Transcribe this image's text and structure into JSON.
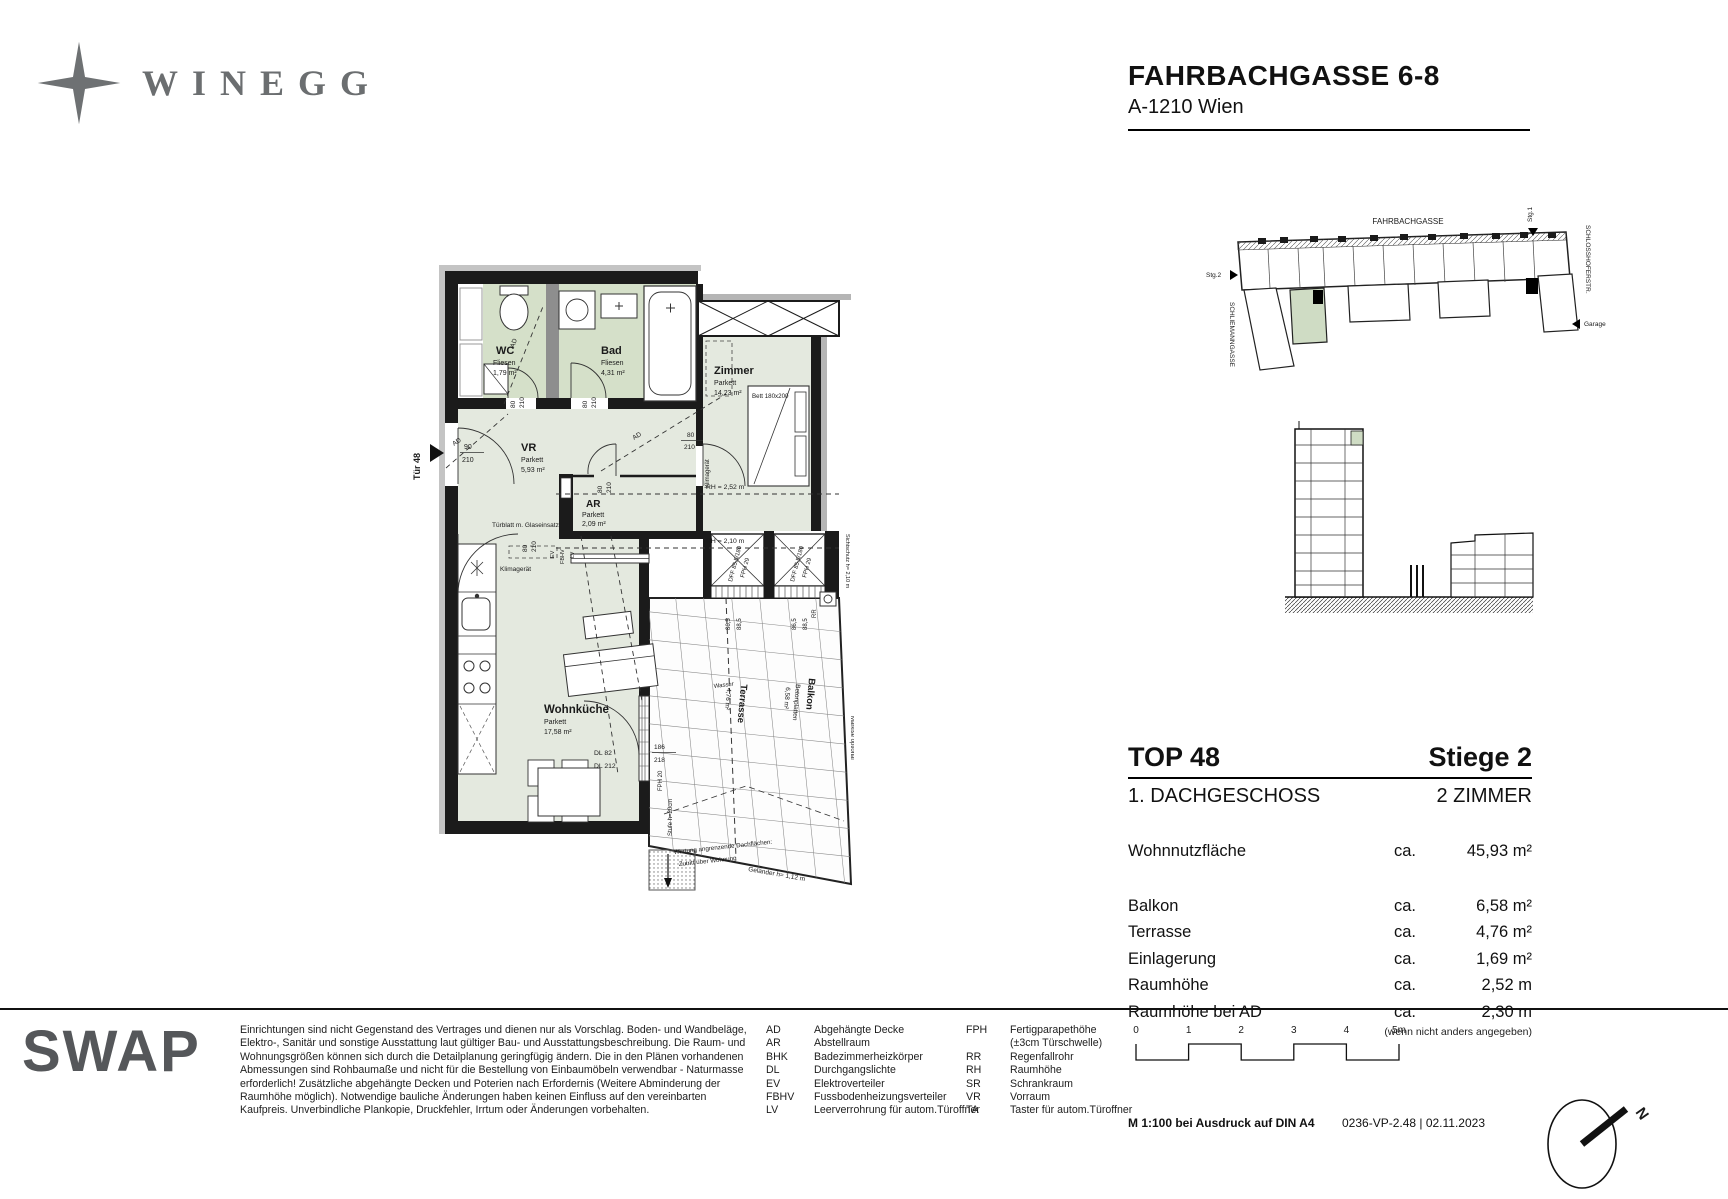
{
  "header": {
    "logo": "WINEGG",
    "title": "FAHRBACHGASSE 6-8",
    "subtitle": "A-1210 Wien"
  },
  "site_plan": {
    "street_top": "FAHRBACHGASSE",
    "street_right": "SCHLOSSHOFERSTR.",
    "street_left": "SCHLIEMANNGASSE",
    "stg1": "Stg.1",
    "stg2": "Stg.2",
    "garage": "Garage"
  },
  "floor_plan": {
    "door_label": "Tür 48",
    "entry_dim": {
      "w": "90",
      "h": "210"
    },
    "door_dim": {
      "w": "80",
      "h": "210"
    },
    "rooms": {
      "wc": {
        "name": "WC",
        "floor": "Fliesen",
        "area": "1,79 m²"
      },
      "bad": {
        "name": "Bad",
        "floor": "Fliesen",
        "area": "4,31 m²"
      },
      "zimmer": {
        "name": "Zimmer",
        "floor": "Parkett",
        "area": "14,23 m²"
      },
      "vr": {
        "name": "VR",
        "floor": "Parkett",
        "area": "5,93 m²"
      },
      "ar": {
        "name": "AR",
        "floor": "Parkett",
        "area": "2,09 m²"
      },
      "wohnkueche": {
        "name": "Wohnküche",
        "floor": "Parkett",
        "area": "17,58 m²"
      },
      "terrasse": {
        "name": "Terrasse",
        "area": "4,76 m²"
      },
      "balkon": {
        "name": "Balkon",
        "floor": "Betonplatten",
        "area": "6,58 m²"
      }
    },
    "annotations": {
      "ad": "AD",
      "bett": "Bett 180x200",
      "rh_high": "RH = 2,52 m",
      "rh_low": "RH = 2,10 m",
      "klimageraet": "Klimagerät",
      "tuerblatt": "Türblatt m. Glaseinsatz",
      "ev": "EV",
      "fbhv": "FBHV",
      "lv": "LV",
      "dff": "DFF 85,5/180",
      "fph29": "FPH 29",
      "dim_865": "86,5",
      "dim_885": "88,5",
      "wasser": "Wasser",
      "dl82": "DL 82",
      "dl212": "DL 212",
      "fph20": "FPH 20",
      "stufe": "Stufe h=20cm",
      "dim_186": "186",
      "dim_218": "218",
      "wartung1": "Wartung angrenzende Dachflächen:",
      "wartung2": "Zutritt über Wohnung",
      "gelaender": "Geländer h= 1,12 m",
      "sichtschutz": "Sichtschutz h= 2,10 m",
      "markise": "Markise optional",
      "rr": "RR"
    }
  },
  "info_panel": {
    "unit": "TOP 48",
    "stair": "Stiege 2",
    "floor": "1. DACHGESCHOSS",
    "room_count": "2 ZIMMER",
    "main_row": {
      "label": "Wohnnutzfläche",
      "prefix": "ca.",
      "value": "45,93 m²"
    },
    "rows": [
      {
        "label": "Balkon",
        "prefix": "ca.",
        "value": "6,58 m²"
      },
      {
        "label": "Terrasse",
        "prefix": "ca.",
        "value": "4,76 m²"
      },
      {
        "label": "Einlagerung",
        "prefix": "ca.",
        "value": "1,69 m²"
      },
      {
        "label": "Raumhöhe",
        "prefix": "ca.",
        "value": "2,52 m"
      },
      {
        "label": "Raumhöhe bei AD",
        "prefix": "ca.",
        "value": "2,30 m"
      }
    ],
    "note": "(wenn nicht anders angegeben)"
  },
  "footer": {
    "brand": "SWAP",
    "disclaimer": "Einrichtungen sind nicht Gegenstand des Vertrages und dienen nur als Vorschlag. Boden- und Wandbeläge, Elektro-, Sanitär und sonstige Ausstattung laut gültiger Bau- und Ausstattungsbeschreibung. Die Raum- und Wohnungsgrößen können sich durch die Detailplanung geringfügig ändern. Die in den Plänen vorhandenen Abmessungen sind Rohbaumaße und nicht für die Bestellung von Einbaumöbeln verwendbar - Naturmasse erforderlich! Zusätzliche abgehängte Decken und Poterien nach Erfordernis (Weitere Abminderung der Raumhöhe möglich). Notwendige bauliche Änderungen haben keinen Einfluss auf den vereinbarten Kaufpreis. Unverbindliche Plankopie, Druckfehler, Irrtum oder Änderungen vorbehalten.",
    "legend_left": [
      {
        "abbr": "AD",
        "text": "Abgehängte Decke"
      },
      {
        "abbr": "AR",
        "text": "Abstellraum"
      },
      {
        "abbr": "BHK",
        "text": "Badezimmerheizkörper"
      },
      {
        "abbr": "DL",
        "text": "Durchgangslichte"
      },
      {
        "abbr": "EV",
        "text": "Elektroverteiler"
      },
      {
        "abbr": "FBHV",
        "text": "Fussbodenheizungsverteiler"
      },
      {
        "abbr": "LV",
        "text": "Leerverrohrung für autom.Türoffner"
      }
    ],
    "legend_right": [
      {
        "abbr": "FPH",
        "text": "Fertigparapethöhe",
        "text2": "(±3cm Türschwelle)"
      },
      {
        "abbr": "RR",
        "text": "Regenfallrohr"
      },
      {
        "abbr": "RH",
        "text": "Raumhöhe"
      },
      {
        "abbr": "SR",
        "text": "Schrankraum"
      },
      {
        "abbr": "VR",
        "text": "Vorraum"
      },
      {
        "abbr": "TA",
        "text": "Taster für autom.Türoffner"
      }
    ],
    "scale_ticks": [
      "0",
      "1",
      "2",
      "3",
      "4",
      "5m"
    ],
    "print_note": "M 1:100 bei Ausdruck auf DIN A4",
    "doc_ref": "0236-VP-2.48 | 02.11.2023",
    "north": "N"
  }
}
